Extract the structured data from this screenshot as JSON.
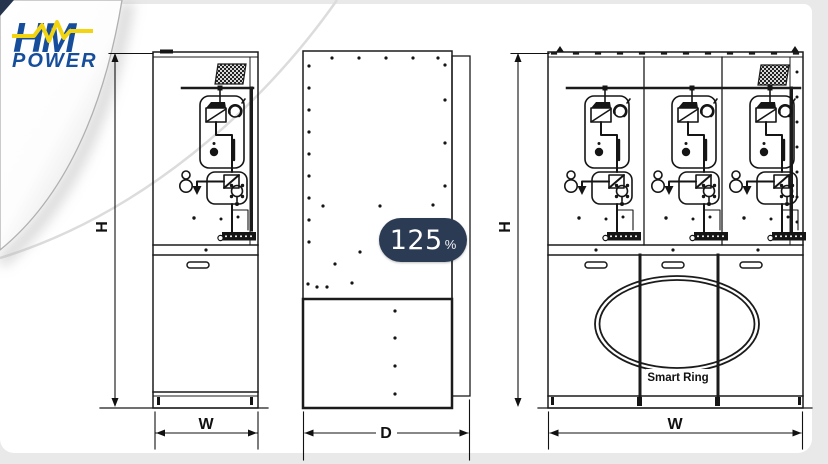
{
  "logo": {
    "word_top": "HM",
    "word_bottom": "POWER",
    "blue": "#174e9b",
    "accent_yellow": "#f2d410"
  },
  "viewer": {
    "zoom_value": "125",
    "zoom_unit": "%",
    "badge_bg": "#2b3b54"
  },
  "drawing": {
    "subject": "ring-main-unit-switchgear-outline-drawing",
    "views": [
      {
        "id": "front-single",
        "dim_vertical": "H",
        "dim_horizontal": "W"
      },
      {
        "id": "side",
        "dim_horizontal": "D"
      },
      {
        "id": "front-triple",
        "dim_vertical": "H",
        "dim_horizontal": "W",
        "label": "Smart Ring"
      }
    ],
    "line_color": "#1b1b1b"
  }
}
